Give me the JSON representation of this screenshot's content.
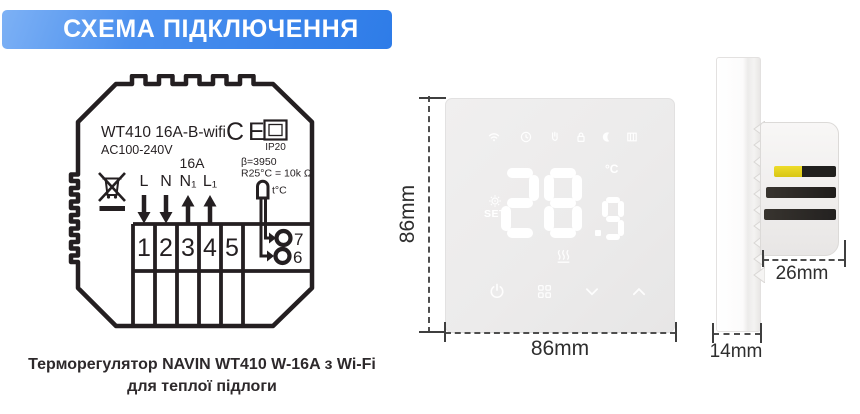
{
  "header": {
    "title": "СХЕМА ПІДКЛЮЧЕННЯ"
  },
  "wiring_diagram": {
    "model": "WT410 16A-B-wifi",
    "voltage": "AC100-240V",
    "current_rating": "16A",
    "ce_mark": "CE",
    "ip_rating": "IP20",
    "sensor_beta": "β=3950",
    "sensor_resistance": "R25°C = 10k Ω",
    "sensor_label": "t°C",
    "input_terminals": [
      "L",
      "N"
    ],
    "output_terminals": [
      "N₁",
      "L₁"
    ],
    "terminal_numbers": [
      "1",
      "2",
      "3",
      "4",
      "5"
    ],
    "sensor_terminal_top": "7",
    "sensor_terminal_bottom": "6"
  },
  "front_view": {
    "display_integer": "28",
    "display_decimal": "9",
    "unit": "°C",
    "set_label": "SET",
    "status_icons": [
      "wifi",
      "clock",
      "manual-hand",
      "lock",
      "moon",
      "open-window"
    ],
    "heating_indicator": "underfloor-heating",
    "buttons": [
      "power",
      "menu",
      "down",
      "up"
    ],
    "width_label": "86mm",
    "height_label": "86mm"
  },
  "side_view": {
    "depth_label": "26mm",
    "thickness_label": "14mm"
  },
  "caption": {
    "line1": "Терморегулятор NAVIN WT410 W-16A з Wi-Fi",
    "line2": "для теплої підлоги"
  },
  "colors": {
    "banner_gradient_start": "#7db1f5",
    "banner_gradient_end": "#2e7ce8",
    "diagram_ink": "#241f21",
    "panel_background": "#ecebeb",
    "display_glyphs": "#ffffff",
    "slot_yellow": "#e5d31f",
    "slot_dark": "#262422"
  }
}
